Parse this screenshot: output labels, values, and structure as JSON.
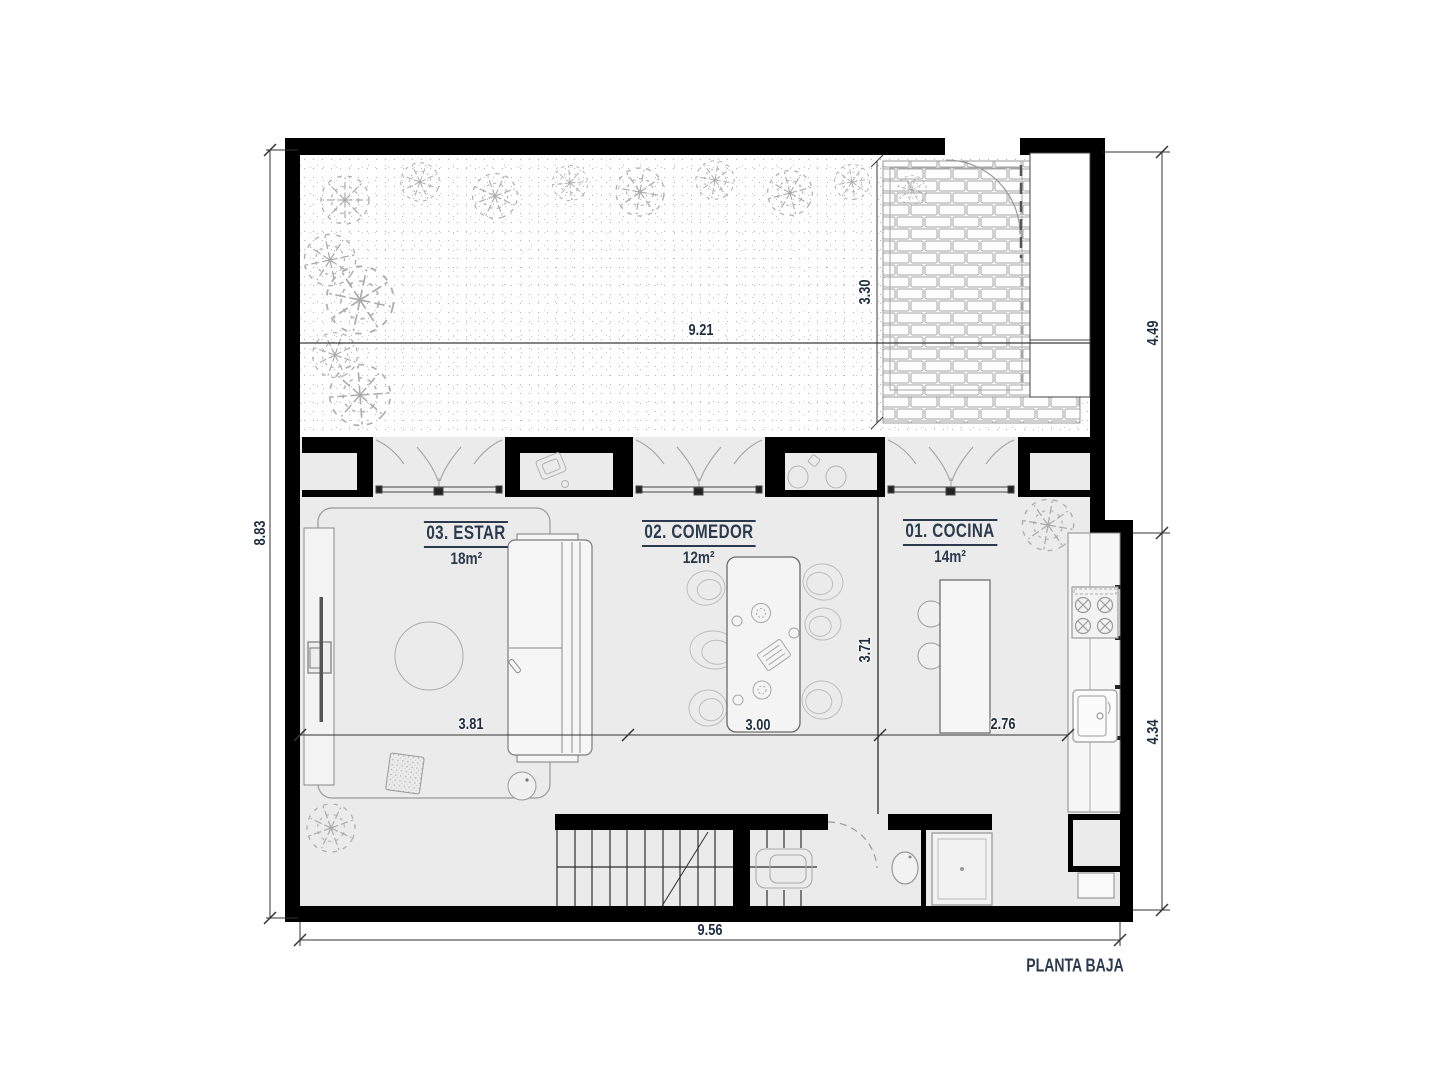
{
  "plan": {
    "title": "PLANTA BAJA",
    "rooms": [
      {
        "id": "01",
        "label": "01. COCINA",
        "area": "14m²"
      },
      {
        "id": "02",
        "label": "02. COMEDOR",
        "area": "12m²"
      },
      {
        "id": "03",
        "label": "03. ESTAR",
        "area": "18m²"
      }
    ],
    "dimensions": {
      "garden_width": "9.21",
      "patio_depth": "3.30",
      "right_upper": "4.49",
      "right_lower": "4.34",
      "left_height": "8.83",
      "estar_width": "3.81",
      "comedor_width": "3.00",
      "cocina_width": "2.76",
      "interior_depth": "3.71",
      "bottom_width": "9.56"
    },
    "colors": {
      "wall": "#000000",
      "floor": "#ebebeb",
      "label_text": "#2b3a4d",
      "dimension_text": "#1d2c3e",
      "sketch_line": "#9a9a9a"
    }
  }
}
